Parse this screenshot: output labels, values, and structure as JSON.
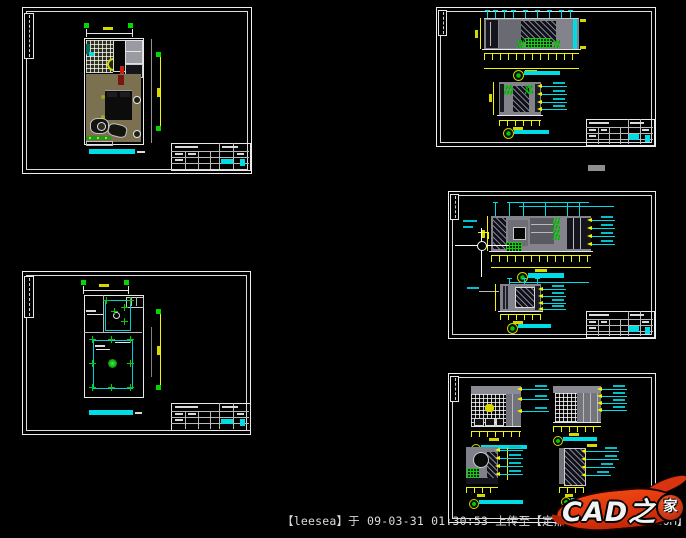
{
  "footer": {
    "upload_info": "【leesea】于 09-03-31 01:30:53 上传至【定鼎网:WWW.DDOVE.COM】"
  },
  "logo": {
    "text_main": "CAD之",
    "text_circle": "家",
    "brand": "CAD之家",
    "color": "#dd330c"
  },
  "colors": {
    "background": "#000000",
    "sheet_border": "#eceff0",
    "dimension_yellow": "#f5f500",
    "annotation_cyan": "#00dce6",
    "marker_green": "#00d800",
    "wall_gray": "#83838b",
    "floor_tan": "#7b7050"
  }
}
